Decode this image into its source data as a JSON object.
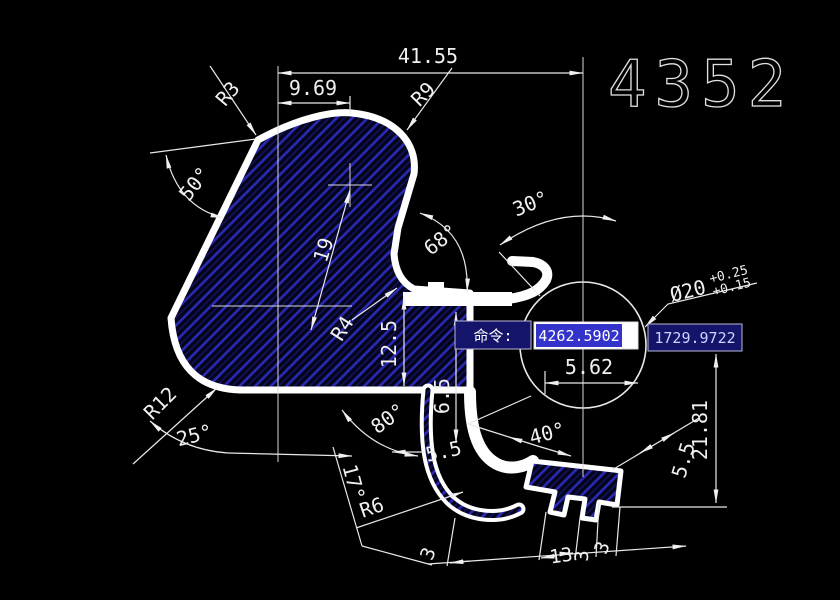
{
  "title": {
    "drawing_number": "4352"
  },
  "command_bar": {
    "label": "命令:",
    "coord_x": "4262.5902",
    "coord_y": "1729.9722"
  },
  "colors": {
    "background": "#000000",
    "profile_white": "#ffffff",
    "hatch_blue": "#2a2ab8",
    "selection_blue": "#3333cc",
    "panel_navy": "#14146a",
    "dim_text": "#f0f0f0"
  },
  "dimensions": {
    "d_41_55": "41.55",
    "d_9_69": "9.69",
    "r3": "R3",
    "r9": "R9",
    "a50": "50°",
    "a30": "30°",
    "a68": "68°",
    "d19": "19",
    "r4": "R4",
    "d12_5": "12.5",
    "d6_5": "6.5",
    "d5_62": "5.62",
    "dia": {
      "main": "Ø20",
      "upper": "+0.25",
      "lower": "+0.15"
    },
    "r12": "R12",
    "a25": "25°",
    "a80": "80°",
    "d5_5": "5.5",
    "a40": "40°",
    "a17": "17°",
    "r6": "R6",
    "d21_81": "21.81",
    "d5_5b": "5.5",
    "b3a": "3",
    "b13": "13",
    "b3b": "3",
    "b3c": "3"
  }
}
